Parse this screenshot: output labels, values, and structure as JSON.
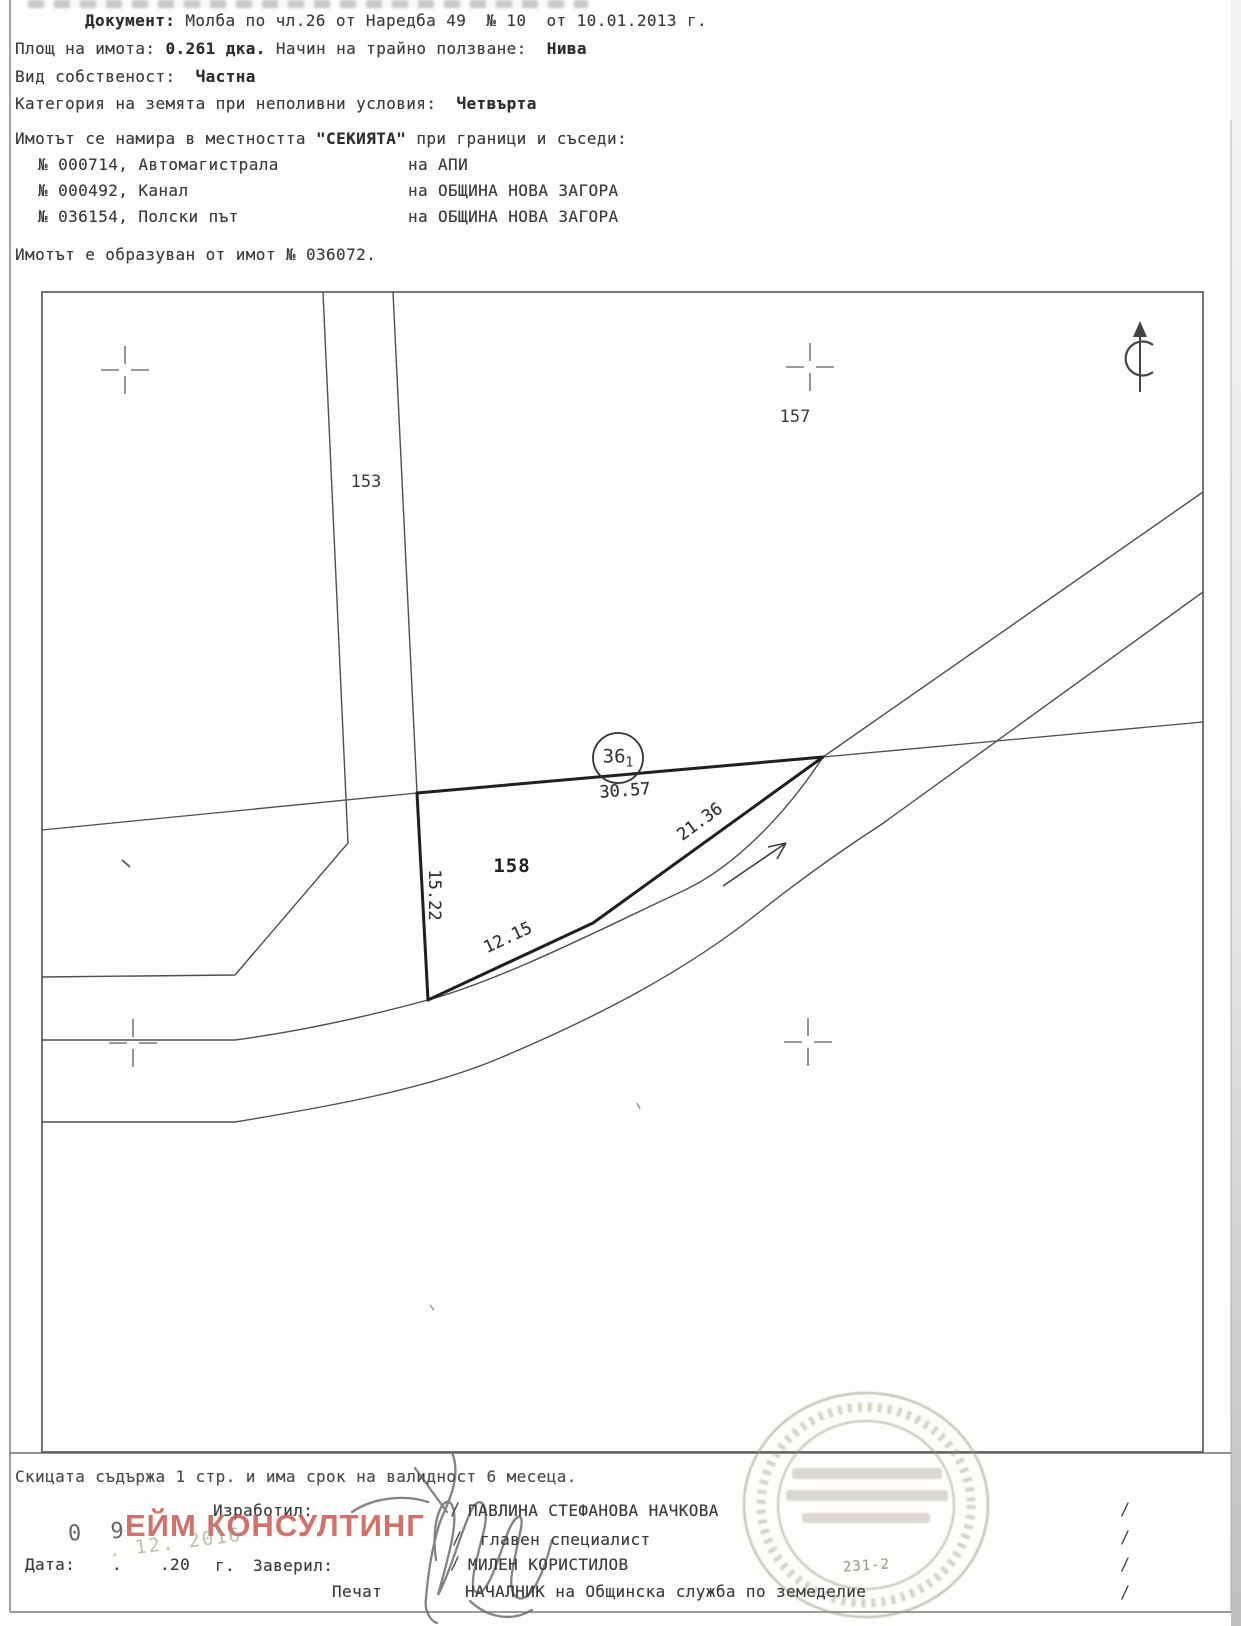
{
  "header": {
    "document_label": "Документ:",
    "document_value": "Молба по чл.26 от Наредба 49  № 10  от 10.01.2013 г.",
    "area_label": "Площ на имота:",
    "area_value": "0.261 дка.",
    "usage_label": "Начин на трайно ползване:",
    "usage_value": "Нива",
    "ownership_label": "Вид собственост:",
    "ownership_value": "Частна",
    "category_label": "Категория на земята при неполивни условия:",
    "category_value": "Четвърта",
    "location_prefix": "Имотът се намира в местността",
    "location_name": "\"СЕКИЯТА\"",
    "location_suffix": "при граници и съседи:",
    "neighbors": [
      {
        "name": "№ 000714, Автомагистрала",
        "na": "на",
        "owner": "АПИ"
      },
      {
        "name": "№ 000492, Канал",
        "na": "на",
        "owner": "ОБЩИНА НОВА ЗАГОРА"
      },
      {
        "name": "№ 036154, Полски път",
        "na": "на",
        "owner": "ОБЩИНА НОВА ЗАГОРА"
      }
    ],
    "origin_line": "Имотът е образуван от имот № 036072."
  },
  "map": {
    "parcel_number": "158",
    "point_circle_main": "36",
    "point_circle_sub": "1",
    "neighbor_parcel_left": "153",
    "neighbor_parcel_topright": "157",
    "dim_top": "30.57",
    "dim_right": "21.36",
    "dim_left": "15.22",
    "dim_bottom": "12.15"
  },
  "footer": {
    "validity_line": "Скицата съдържа 1 стр. и има срок на валидност 6 месеца.",
    "author_label": "Изработил:",
    "author_name": "ПАВЛИНА СТЕФАНОВА НАЧКОВА",
    "author_title": "главен специалист",
    "date_label": "Дата:",
    "date_dot": ".",
    "date_year": ".20",
    "date_g": "г.",
    "verify_label": "Заверил:",
    "verifier_name": "МИЛЕН КОРИСТИЛОВ",
    "verifier_title": "НАЧАЛНИК на Общинска служба по земеделие",
    "seal_label": "Печат",
    "stamp_number": "231-2",
    "date_stamp_day": "0 9",
    "date_stamp_rest": ". 12. 2016",
    "watermark": "ЕЙМ КОНСУЛТИНГ",
    "slash": "/"
  },
  "colors": {
    "ink": "#3a3a3a",
    "parcel_line": "#1f1f1f",
    "thin_line": "#555555",
    "watermark_red": "#c5534d",
    "stamp_gray": "#9e9482"
  }
}
